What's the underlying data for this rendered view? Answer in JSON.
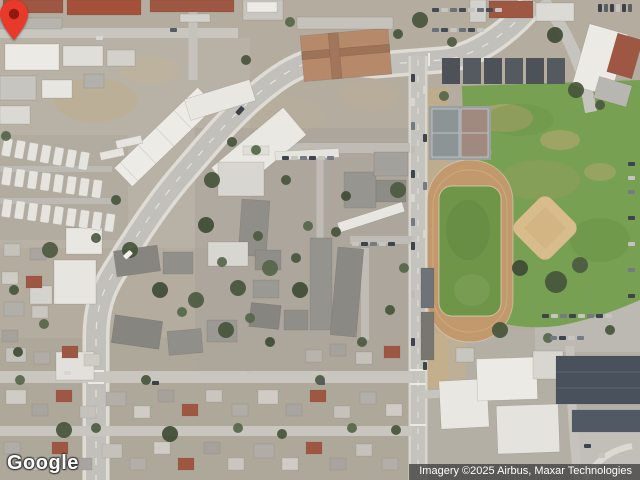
{
  "map": {
    "view_type": "satellite",
    "logo_text": "Google",
    "attribution_text": "Imagery ©2025 Airbus, Maxar Technologies"
  },
  "marker": {
    "kind": "location-pin",
    "color": "#e8392b",
    "inner_color": "#8e1b0d",
    "tip_x": 321,
    "tip_y": 241
  },
  "colors": {
    "field_green": "#78a052",
    "track_tan": "#c2996c",
    "infield_tan": "#d9bc8c",
    "road_gray": "#c3c1bc",
    "roof_red": "#9e5743",
    "attribution_bg": "rgba(66,66,66,0.8)"
  }
}
